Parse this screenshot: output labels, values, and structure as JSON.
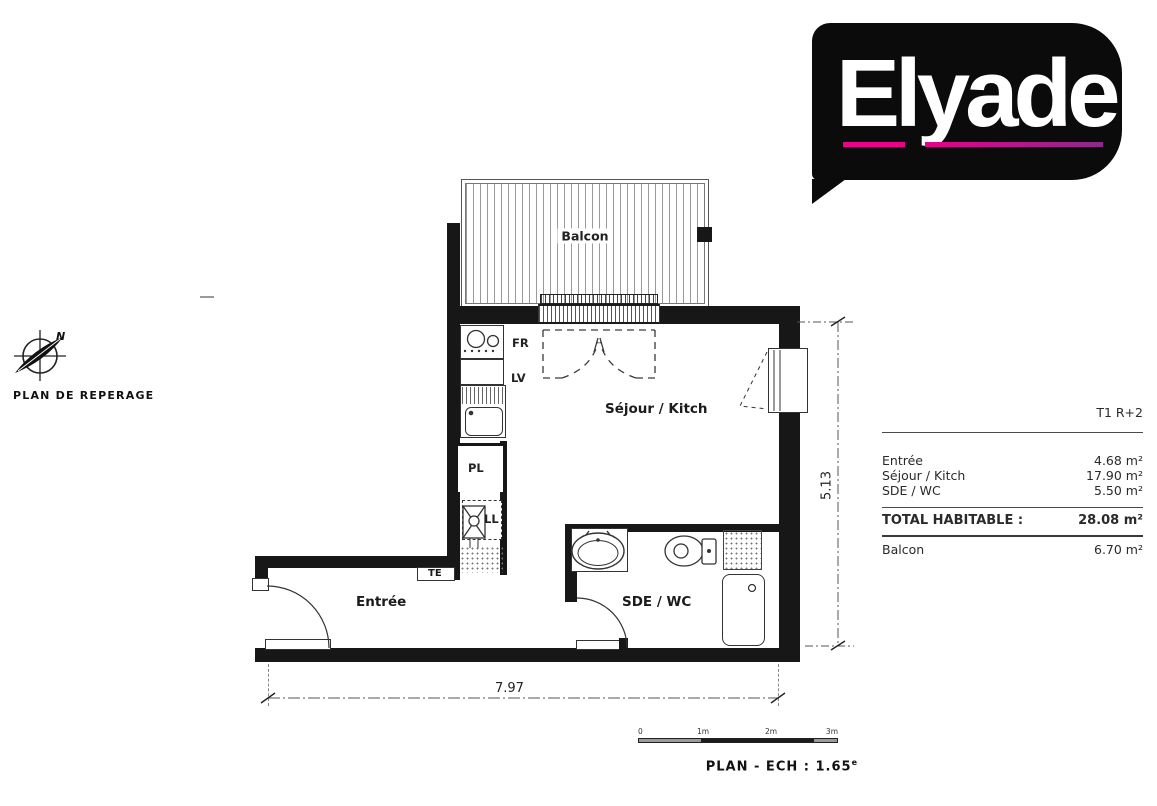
{
  "logo": {
    "text": "Elyade"
  },
  "locator": {
    "caption": "PLAN DE REPERAGE",
    "north": "N"
  },
  "plan": {
    "labels": {
      "balcony": "Balcon",
      "living": "Séjour / Kitch",
      "entry": "Entrée",
      "bath": "SDE / WC",
      "fridge": "FR",
      "dishwasher": "LV",
      "closet": "PL",
      "washer": "LL",
      "electrical": "TE"
    },
    "dims": {
      "width": "7.97",
      "height": "5.13"
    }
  },
  "scalebar": {
    "ticks": [
      "0",
      "1m",
      "2m",
      "3m"
    ],
    "caption": "PLAN - ECH : 1.65",
    "caption_sup": "e"
  },
  "table": {
    "type": "T1 R+2",
    "rows": [
      {
        "label": "Entrée",
        "value": "4.68 m²"
      },
      {
        "label": "Séjour / Kitch",
        "value": "17.90 m²"
      },
      {
        "label": "SDE / WC",
        "value": "5.50 m²"
      }
    ],
    "total": {
      "label": "TOTAL HABITABLE :",
      "value": "28.08 m²"
    },
    "annex": {
      "label": "Balcon",
      "value": "6.70 m²"
    }
  },
  "colors": {
    "wall": "#171717",
    "accent_pink": "#ec008c",
    "accent_purple": "#8a2b8c"
  }
}
